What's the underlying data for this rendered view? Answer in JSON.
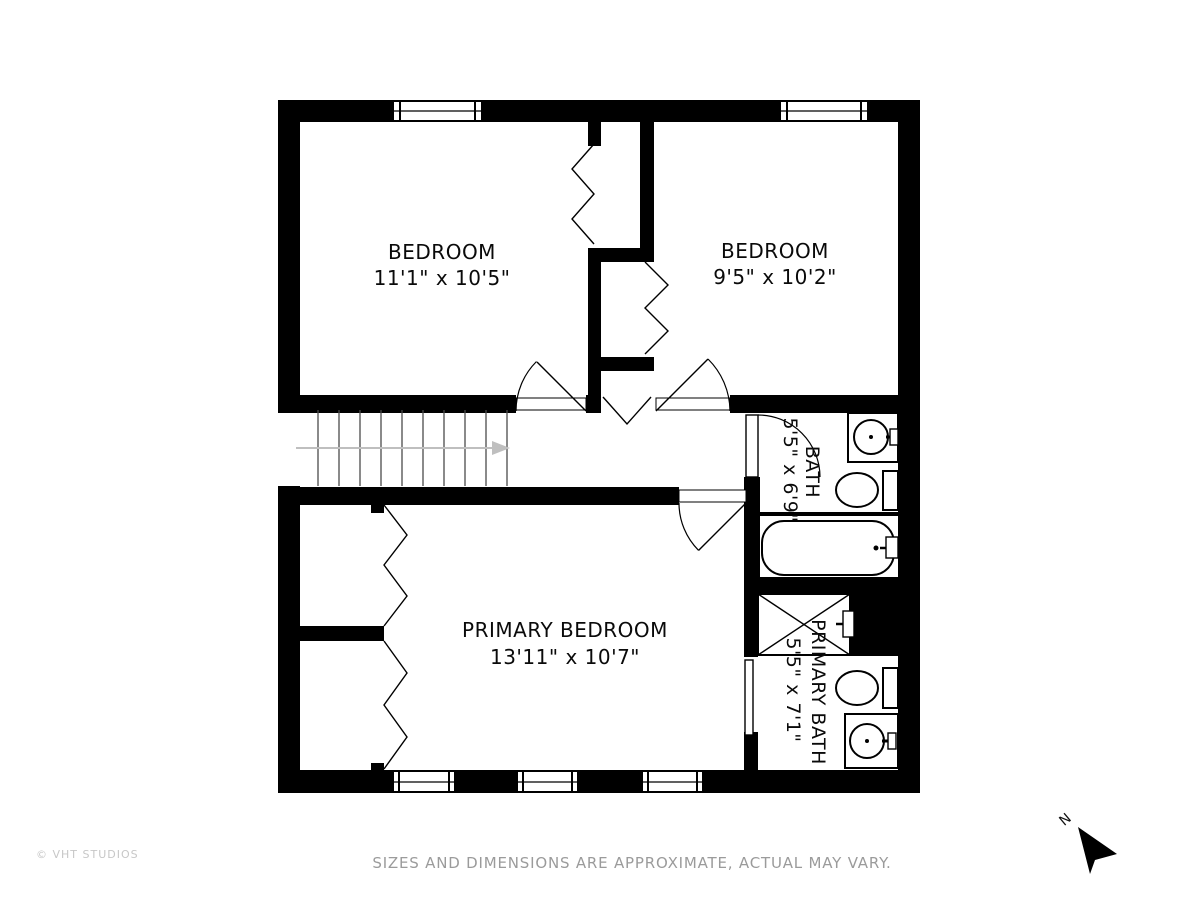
{
  "rooms": {
    "bedroom1": {
      "name": "BEDROOM",
      "dimensions": "11'1\" x 10'5\""
    },
    "bedroom2": {
      "name": "BEDROOM",
      "dimensions": "9'5\" x 10'2\""
    },
    "primary_bedroom": {
      "name": "PRIMARY BEDROOM",
      "dimensions": "13'11\" x 10'7\""
    },
    "bath": {
      "name": "BATH",
      "dimensions": "5'5\" x 6'9\""
    },
    "primary_bath": {
      "name": "PRIMARY BATH",
      "dimensions": "5'5\" x 7'1\""
    }
  },
  "compass": {
    "north_label": "N"
  },
  "footer": {
    "copyright": "© VHT STUDIOS",
    "disclaimer": "SIZES AND DIMENSIONS ARE APPROXIMATE, ACTUAL MAY VARY."
  },
  "colors": {
    "wall": "#000000",
    "background": "#ffffff",
    "stair_arrow": "#bfbfbf",
    "disclaimer_text": "#9b9b9b",
    "copyright_text": "#c7c7c7"
  }
}
